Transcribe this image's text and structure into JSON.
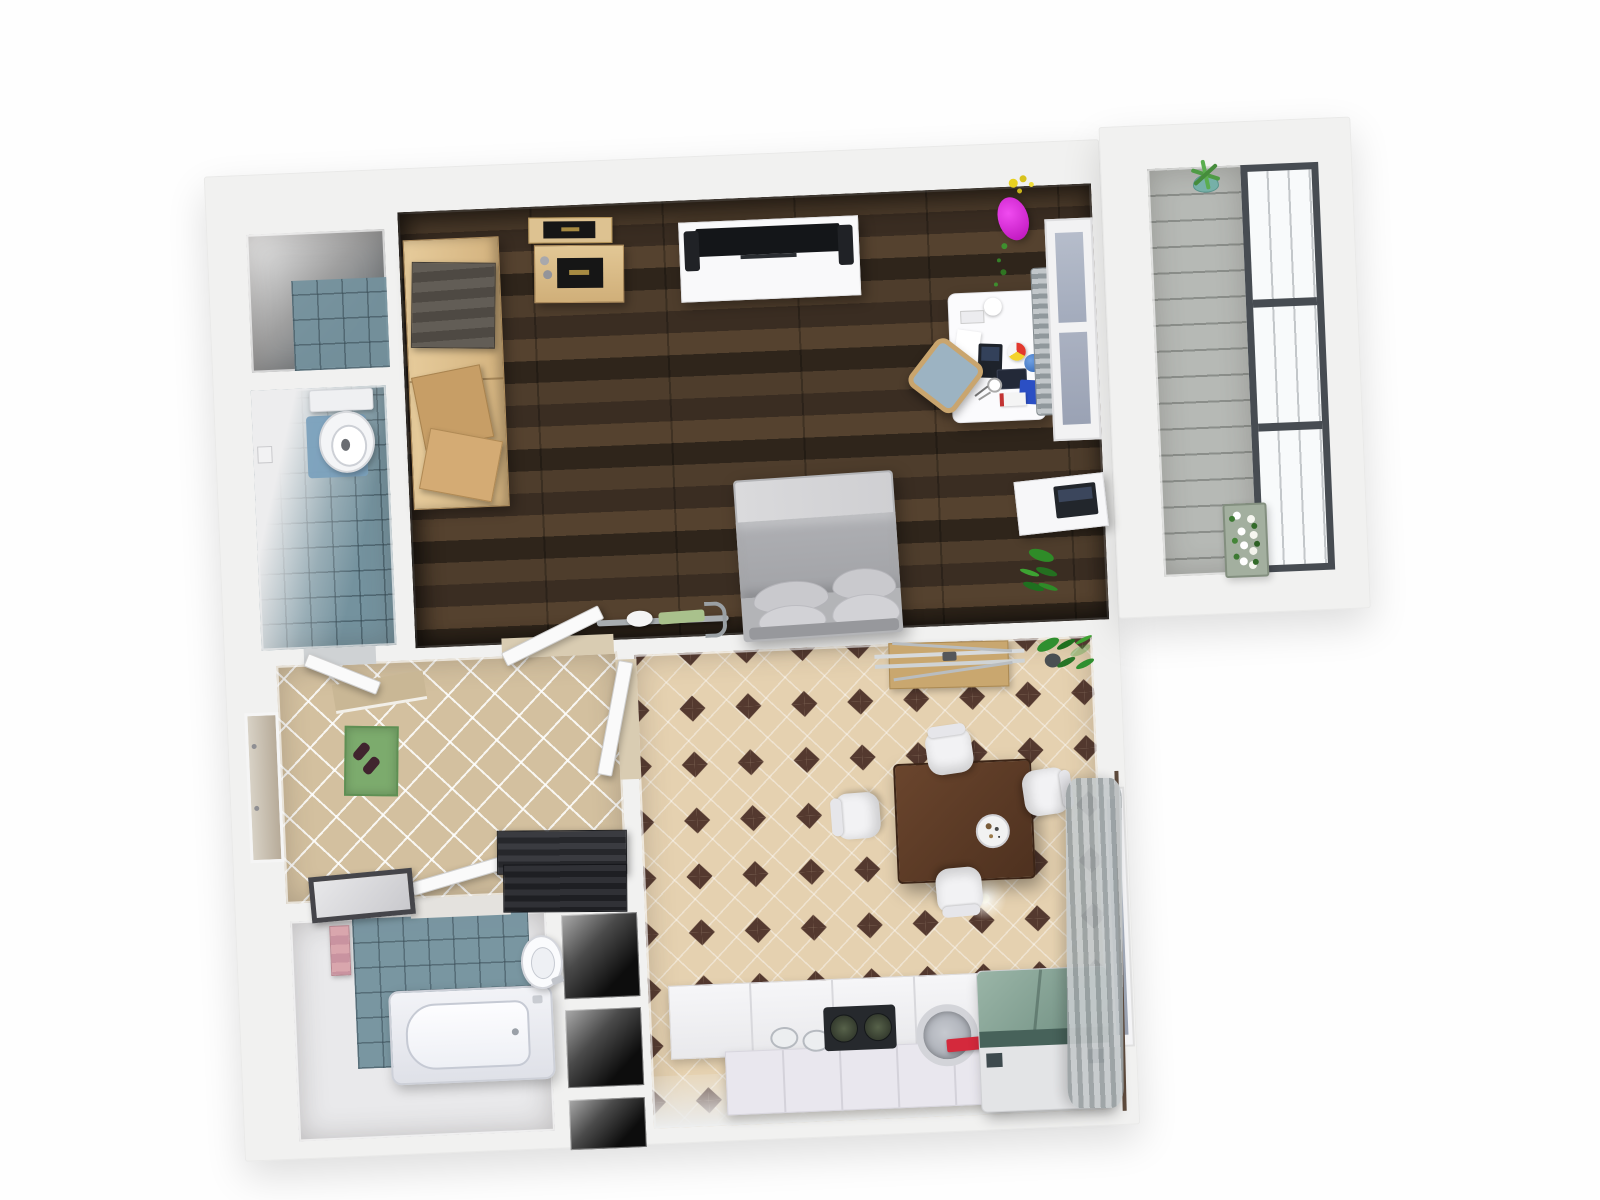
{
  "scene": {
    "view": "top-down 3D rendered floor plan of a one-bedroom apartment",
    "rotation_deg": -2.4,
    "background_color": "#fefefe",
    "wall_color": "#f1f1f0"
  },
  "palette": {
    "wood_floor": "#42342a",
    "blue_tile": "#74929e",
    "hall_tile": "#d3c09f",
    "kitchen_tile": "#e5d1b0",
    "kitchen_diamond": "#54392f",
    "balcony_deck": "#b6b9b5",
    "bath_floor": "#e9e9eb",
    "accent_magenta": "#d916d9",
    "accent_yellow": "#e8d11f",
    "accent_green_mat": "#7cab6d",
    "accent_red": "#d4293c",
    "fridge_teal": "#6e8d80",
    "curtain_gray": "#9aa1a3",
    "window_frame_dark": "#474c52"
  },
  "rooms": {
    "storage": {
      "label": "Storage room",
      "floor": "blue tile"
    },
    "toilet": {
      "label": "Toilet room",
      "floor": "blue tile"
    },
    "living": {
      "label": "Living / bedroom",
      "floor": "dark wood planks"
    },
    "hallway": {
      "label": "Hallway",
      "floor": "beige diagonal tile"
    },
    "bathroom": {
      "label": "Bathroom",
      "floor": "light floor with blue tile zone"
    },
    "shelving": {
      "label": "Open shelf niches"
    },
    "kitchen": {
      "label": "Kitchen / dining room",
      "floor": "beige tile with dark diamonds"
    },
    "balcony": {
      "label": "Balcony",
      "floor": "grey decking"
    }
  },
  "furniture": {
    "wardrobe": {
      "label": "Wardrobe with towel stack and folded clothes"
    },
    "wall_shelf": {
      "label": "Wall shelf with framed art"
    },
    "sideboard": {
      "label": "Sideboard with framed art"
    },
    "tv_stand": {
      "label": "TV stand with television and speakers"
    },
    "flower_vase": {
      "label": "Pink vase with yellow flowers"
    },
    "desk": {
      "label": "Desk with laptop, beach ball, globe and books"
    },
    "desk_chair": {
      "label": "Desk chair with blue cushion"
    },
    "radiator": {
      "label": "Radiator"
    },
    "window_living": {
      "label": "Window"
    },
    "bed": {
      "label": "Double bed with pillows"
    },
    "exercise_bike": {
      "label": "Exercise bike"
    },
    "laptop_table": {
      "label": "Laptop side table"
    },
    "plant_living": {
      "label": "Potted plant"
    },
    "toilet": {
      "label": "Toilet with blue mat"
    },
    "toilet_paper": {
      "label": "Toilet paper holder"
    },
    "entry_mat": {
      "label": "Green entry mat with shoes"
    },
    "entrance_door": {
      "label": "Entrance door recess"
    },
    "shoe_rack": {
      "label": "Dark slatted shoe bench"
    },
    "floor_mirror": {
      "label": "Framed mirror on floor"
    },
    "bathtub": {
      "label": "Bathtub"
    },
    "washbasin": {
      "label": "Round washbasin"
    },
    "towels_pink": {
      "label": "Pink towels on rail"
    },
    "dining_table": {
      "label": "Dark wood dining table"
    },
    "dining_chair": {
      "label": "White dining chair"
    },
    "plate": {
      "label": "Plate with food"
    },
    "clothes_airer": {
      "label": "Clothes drying rack on wooden mat"
    },
    "plant_kitchen": {
      "label": "Potted plant"
    },
    "ceiling_light": {
      "label": "Ceiling light"
    },
    "kitchen_counter": {
      "label": "Kitchen counter with sink and stove"
    },
    "stove": {
      "label": "Two-burner stove"
    },
    "washing_machine": {
      "label": "Washing machine"
    },
    "fridge": {
      "label": "Fridge freezer with teal top"
    },
    "curtain": {
      "label": "Grey curtain with rod"
    },
    "kitchen_window": {
      "label": "Kitchen window"
    },
    "aloe_plant": {
      "label": "Aloe plant in teal pot"
    },
    "flower_planter": {
      "label": "Planter with white flowers"
    },
    "balcony_window": {
      "label": "Panorama window"
    },
    "interior_door": {
      "label": "Open interior door"
    }
  }
}
